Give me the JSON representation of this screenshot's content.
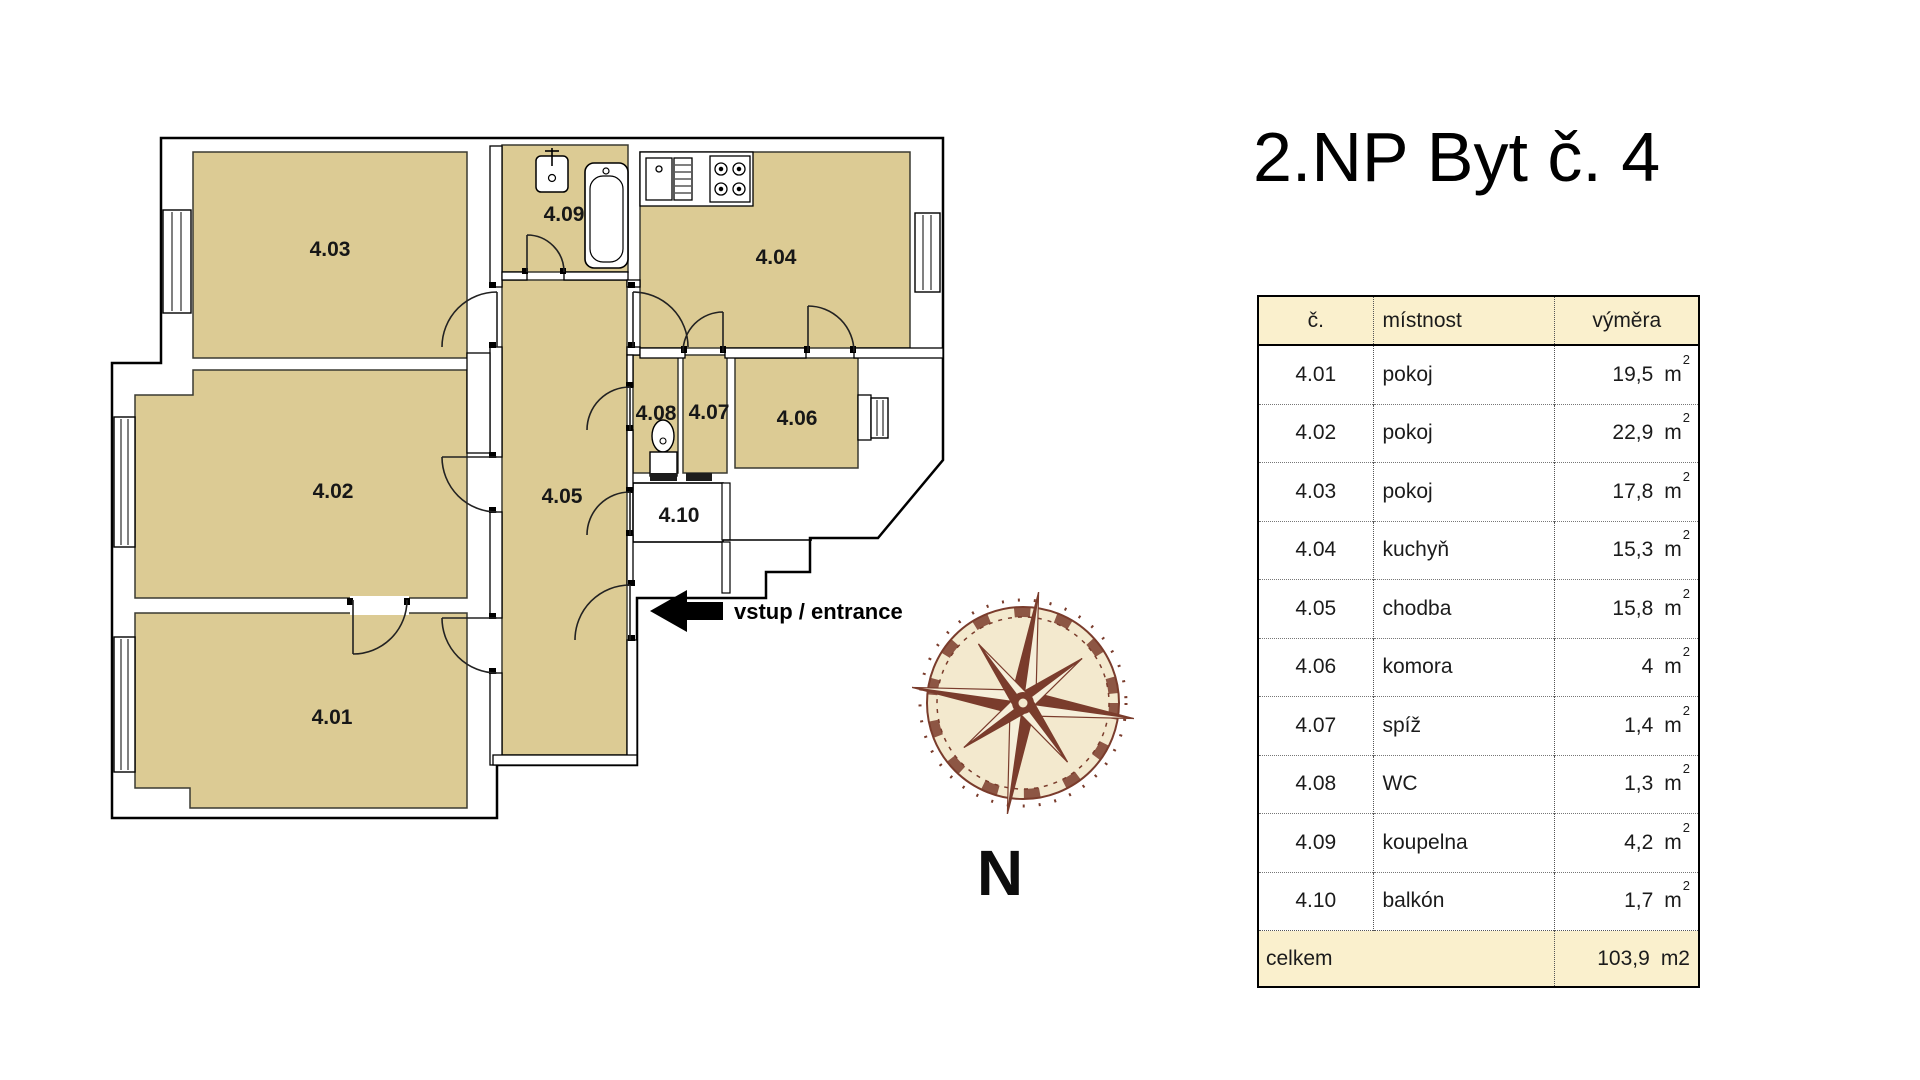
{
  "title": "2.NP Byt č. 4",
  "floorplan": {
    "room_labels": {
      "r401": "4.01",
      "r402": "4.02",
      "r403": "4.03",
      "r404": "4.04",
      "r405": "4.05",
      "r406": "4.06",
      "r407": "4.07",
      "r408": "4.08",
      "r409": "4.09",
      "r410": "4.10"
    },
    "entrance_label": "vstup / entrance",
    "compass_label": "N",
    "room_fill_color": "#dccb94",
    "compass_color": "#7a3c2c"
  },
  "table": {
    "headers": {
      "no": "č.",
      "room": "místnost",
      "area": "výměra"
    },
    "unit": "m",
    "unit_sup": "2",
    "header_bg": "#faf0cd",
    "rows": [
      {
        "no": "4.01",
        "room": "pokoj",
        "area": "19,5"
      },
      {
        "no": "4.02",
        "room": "pokoj",
        "area": "22,9"
      },
      {
        "no": "4.03",
        "room": "pokoj",
        "area": "17,8"
      },
      {
        "no": "4.04",
        "room": "kuchyň",
        "area": "15,3"
      },
      {
        "no": "4.05",
        "room": "chodba",
        "area": "15,8"
      },
      {
        "no": "4.06",
        "room": "komora",
        "area": "4"
      },
      {
        "no": "4.07",
        "room": "spíž",
        "area": "1,4"
      },
      {
        "no": "4.08",
        "room": "WC",
        "area": "1,3"
      },
      {
        "no": "4.09",
        "room": "koupelna",
        "area": "4,2"
      },
      {
        "no": "4.10",
        "room": "balkón",
        "area": "1,7"
      }
    ],
    "total": {
      "label": "celkem",
      "value": "103,9",
      "unit": "m2"
    }
  }
}
